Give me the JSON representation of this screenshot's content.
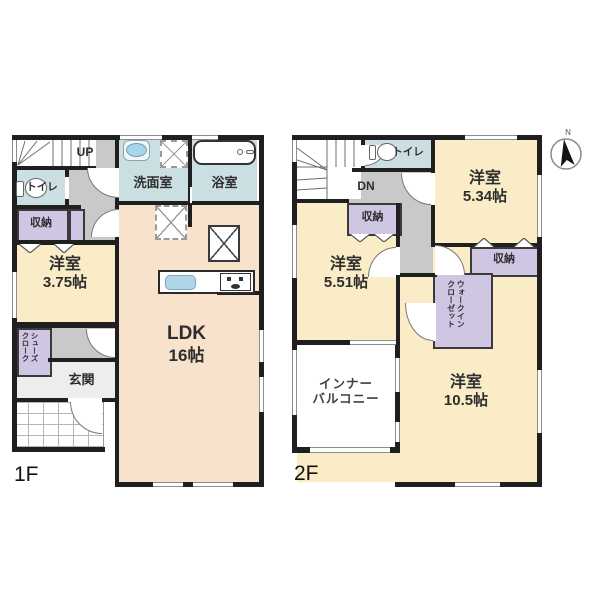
{
  "floor1": {
    "label": "1F",
    "stairs": "UP",
    "toilet": "トイレ",
    "storage": "収納",
    "washroom": "洗面室",
    "bathroom": "浴室",
    "bedroom": {
      "name": "洋室",
      "size": "3.75帖"
    },
    "ldk": {
      "name": "LDK",
      "size": "16帖"
    },
    "shoe_closet": {
      "col1": "シューズ",
      "col2": "クローク"
    },
    "entrance": "玄関"
  },
  "floor2": {
    "label": "2F",
    "stairs": "DN",
    "toilet": "トイレ",
    "storage_hall": "収納",
    "storage_bedroom": "収納",
    "bedroom_a": {
      "name": "洋室",
      "size": "5.34帖"
    },
    "bedroom_b": {
      "name": "洋室",
      "size": "5.51帖"
    },
    "bedroom_c": {
      "name": "洋室",
      "size": "10.5帖"
    },
    "walk_in_closet": {
      "col1": "ウォークイン",
      "col2": "クローゼット"
    },
    "inner_balcony": {
      "line1": "インナー",
      "line2": "バルコニー"
    }
  },
  "compass": {
    "north": "N"
  },
  "palette": {
    "wall": "#1f1f1f",
    "bedroom": "#f9ecc7",
    "ldk": "#f8e2cb",
    "wet_room": "#cbdfe2",
    "storage": "#cfc6e4",
    "hallway": "#c9c9c9",
    "entrance_floor": "#ededed"
  }
}
